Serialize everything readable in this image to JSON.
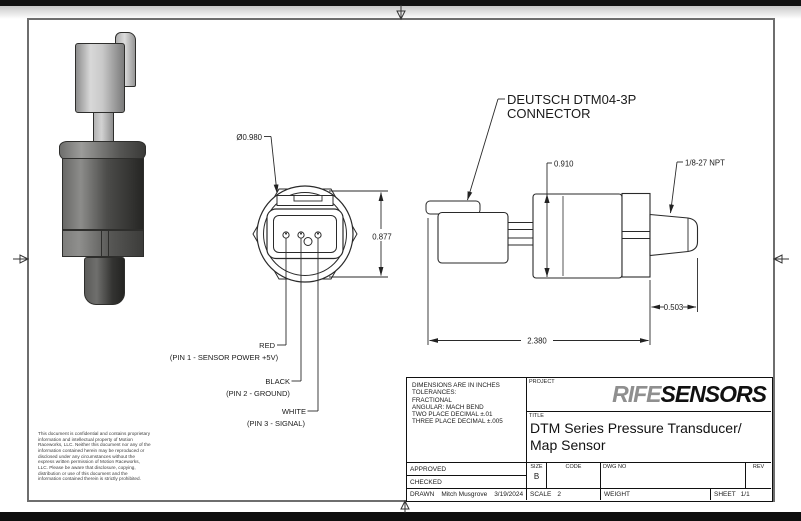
{
  "drawing": {
    "front_view": {
      "diameter_label": "Ø0.980",
      "height_label": "0.877",
      "pin_labels": [
        {
          "wire": "RED",
          "desc": "(PIN 1 - SENSOR POWER +5V)"
        },
        {
          "wire": "BLACK",
          "desc": "(PIN 2 - GROUND)"
        },
        {
          "wire": "WHITE",
          "desc": "(PIN 3 - SIGNAL)"
        }
      ]
    },
    "side_view": {
      "connector_note": [
        "DEUTSCH DTM04-3P",
        "CONNECTOR"
      ],
      "body_height_label": "0.910",
      "thread_label": "1/8-27 NPT",
      "thread_length_label": "0.503",
      "overall_length_label": "2.380"
    }
  },
  "disclaimer": "This document is confidential and contains proprietary information and intellectual property of Motion Raceworks, LLC. Neither this document nor any of the information contained herein may be reproduced or disclosed under any circumstances without the express written permission of Motion Raceworks, LLC. Please be aware that disclosure, copying, distribution or use of this document and the information contained therein is strictly prohibited.",
  "title_block": {
    "tolerance_notes": [
      "DIMENSIONS ARE IN INCHES",
      "TOLERANCES:",
      "FRACTIONAL",
      "ANGULAR: MACH BEND",
      "TWO PLACE DECIMAL ±.01",
      "THREE PLACE DECIMAL ±.005"
    ],
    "project_label": "PROJECT",
    "brand": {
      "part1": "RIFE",
      "part2": "SENSORS",
      "part1_color": "#8f8f8f",
      "part2_color": "#101010"
    },
    "title_label": "TITLE",
    "title_lines": [
      "DTM Series Pressure Transducer/",
      "Map Sensor"
    ],
    "rows": {
      "approved_label": "APPROVED",
      "checked_label": "CHECKED",
      "drawn_label": "DRAWN",
      "drawn_by": "Mitch Musgrove",
      "drawn_date": "3/19/2024"
    },
    "size_label": "SIZE",
    "size_value": "B",
    "code_label": "CODE",
    "dwg_no_label": "DWG NO",
    "rev_label": "REV",
    "scale_label": "SCALE",
    "scale_value": "2",
    "weight_label": "WEIGHT",
    "sheet_label": "SHEET",
    "sheet_value": "1/1"
  }
}
